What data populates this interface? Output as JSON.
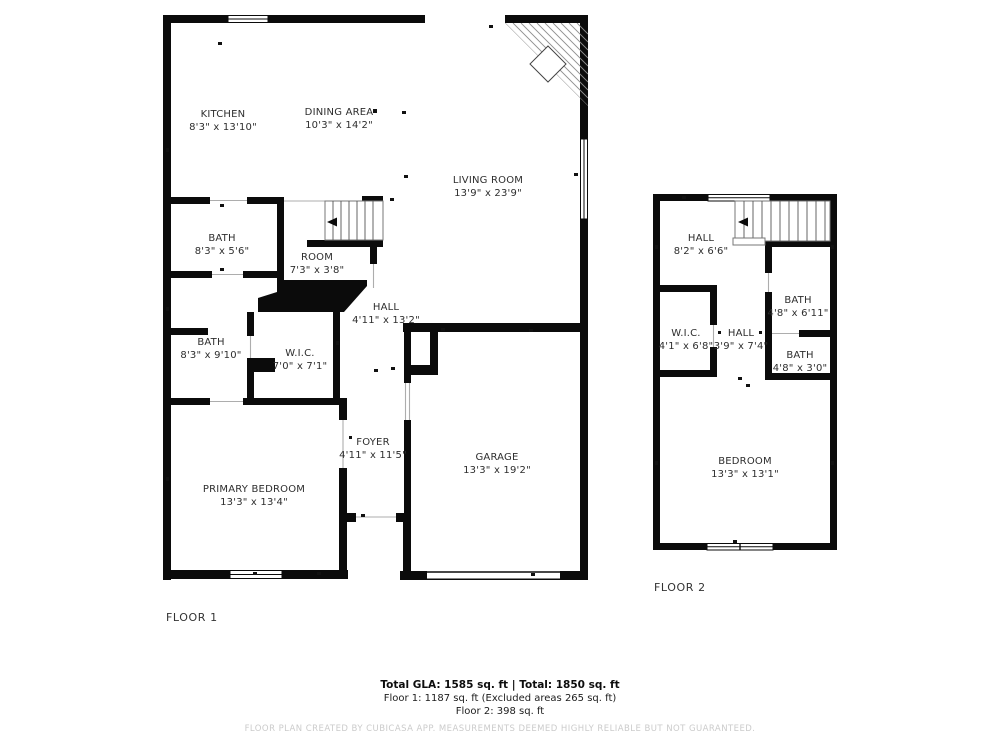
{
  "floor1": {
    "label": "FLOOR 1",
    "rooms": [
      {
        "name": "KITCHEN",
        "dims": "8'3\" x 13'10\""
      },
      {
        "name": "DINING AREA",
        "dims": "10'3\" x 14'2\""
      },
      {
        "name": "LIVING ROOM",
        "dims": "13'9\" x 23'9\""
      },
      {
        "name": "BATH",
        "dims": "8'3\" x 5'6\""
      },
      {
        "name": "ROOM",
        "dims": "7'3\" x 3'8\""
      },
      {
        "name": "HALL",
        "dims": "4'11\" x 13'2\""
      },
      {
        "name": "BATH",
        "dims": "8'3\" x 9'10\""
      },
      {
        "name": "W.I.C.",
        "dims": "7'0\" x 7'1\""
      },
      {
        "name": "FOYER",
        "dims": "4'11\" x 11'5\""
      },
      {
        "name": "PRIMARY BEDROOM",
        "dims": "13'3\" x 13'4\""
      },
      {
        "name": "GARAGE",
        "dims": "13'3\" x 19'2\""
      }
    ]
  },
  "floor2": {
    "label": "FLOOR 2",
    "rooms": [
      {
        "name": "HALL",
        "dims": "8'2\" x 6'6\""
      },
      {
        "name": "BATH",
        "dims": "4'8\" x 6'11\""
      },
      {
        "name": "W.I.C.",
        "dims": "4'1\" x 6'8\""
      },
      {
        "name": "HALL",
        "dims": "3'9\" x 7'4\""
      },
      {
        "name": "BATH",
        "dims": "4'8\" x 3'0\""
      },
      {
        "name": "BEDROOM",
        "dims": "13'3\" x 13'1\""
      }
    ]
  },
  "summary": {
    "total": "Total GLA: 1585 sq. ft | Total: 1850 sq. ft",
    "floor1": "Floor 1: 1187 sq. ft (Excluded areas 265 sq. ft)",
    "floor2": "Floor 2: 398 sq. ft"
  },
  "watermark": "FLOOR PLAN CREATED BY CUBICASA APP. MEASUREMENTS DEEMED HIGHLY RELIABLE BUT NOT GUARANTEED.",
  "colors": {
    "wall": "#0b0b0b",
    "label": "#2e2e2e",
    "watermark": "#cbcbcb"
  }
}
